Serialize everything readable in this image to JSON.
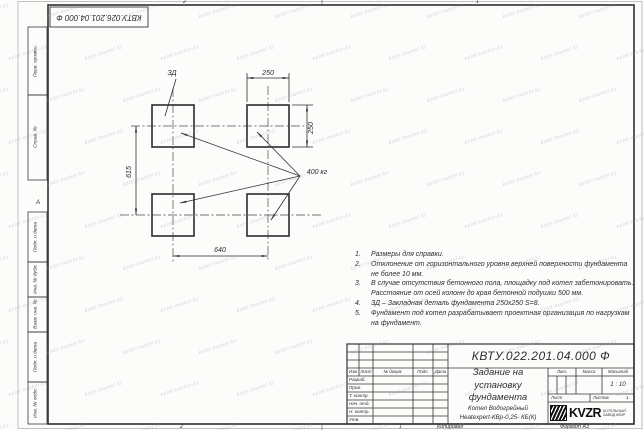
{
  "watermark": {
    "text": "kotel-market.kz"
  },
  "frame": {
    "zone_top_left": "2",
    "zone_top_right": "1",
    "zone_bottom_left": "2",
    "zone_bottom_right": "1",
    "zone_row_letter": "А"
  },
  "top_stamp": {
    "docnum_rotated": "КВТУ.026.201.04.000 Ф"
  },
  "margin_columns": [
    "Перв. примен.",
    "Справ. №",
    "Подп. и дата",
    "Инв. № дубл.",
    "Взам. инв. №",
    "Подп. и дата",
    "Инв. № подл."
  ],
  "drawing": {
    "embed_label": "ЗД",
    "load_label": "400 кг",
    "dim_top": "250",
    "dim_right": "250",
    "dim_left": "615",
    "dim_bottom": "640"
  },
  "notes": {
    "items": [
      {
        "n": "1.",
        "t": "Размеры для справки."
      },
      {
        "n": "2.",
        "t": "Отклонение от горизонтального уровня верхней поверхности фундамента не более 10 мм."
      },
      {
        "n": "3.",
        "t": "В случае отсутствия бетонного пола, площадку под котел забетонировать. Расстояние от осей колонн до края бетонной подушки 500 мм."
      },
      {
        "n": "4.",
        "t": "ЗД – Закладная деталь фундамента 250х250 S=8."
      },
      {
        "n": "5.",
        "t": "Фундамент под котел разрабатывает проектная организация по нагрузкам на фундамент."
      }
    ]
  },
  "title_block": {
    "doc_number": "КВТУ.022.201.04.000 Ф",
    "title": "Задание на установку фундамента",
    "product_line1": "Котел Водогрейный",
    "product_line2": "Heatexpert-КВр-0,25- КБ(К)",
    "header": [
      "Изм",
      "Лист",
      "№ докум.",
      "Подп.",
      "Дата"
    ],
    "rows": [
      "Разраб.",
      "Пров.",
      "Т. контр.",
      "Нач. отд.",
      "Н. контр.",
      "Утв."
    ],
    "lit_label": "Лит.",
    "massa_label": "Масса",
    "masshtab_label": "Масштаб",
    "scale_value": "1 : 10",
    "list_label": "Лист",
    "listov_label": "Листов",
    "listov_value": "1",
    "logo_text": "KVZR",
    "logo_sub_line1": "КОТЕЛЬНЫЙ",
    "logo_sub_line2": "ЗАВОД КВЗР",
    "kopiroval": "Копировал",
    "format": "Формат А3"
  }
}
